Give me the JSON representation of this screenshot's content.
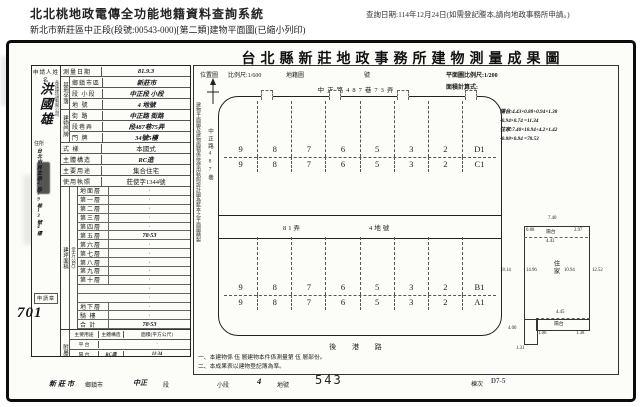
{
  "header": {
    "system_title": "北北桃地政電傳全功能地籍資料查詢系統",
    "query_date": "查詢日期:114年12月24日(如需登記謄本,請向地政事務所申請。)",
    "subtitle": "新北市新莊區中正段(段號:00543-000)[第二類]建物平面圖(已縮小列印)"
  },
  "doc": {
    "title": "台北縣新莊地政事務所建物測量成果圖"
  },
  "applicant": {
    "label": "申請人姓名",
    "name": "洪國雄",
    "company": "永達建設有限公司",
    "addr_label": "住所",
    "address": "台北市民生路2段79巷13號4樓",
    "stamp": "申請章",
    "receipt_no": "701"
  },
  "form": {
    "site_group": "基地坐落",
    "door_group": "建物門牌",
    "rows": [
      {
        "label": "測量日期",
        "value": "81.9.3"
      },
      {
        "label": "鄉鎮市區",
        "value": "新莊市"
      },
      {
        "label": "段 小段",
        "value": "中正段 小段"
      },
      {
        "label": "地 號",
        "value": "4 地號"
      },
      {
        "label": "街 路",
        "value": "中正路 街路"
      },
      {
        "label": "段巷弄",
        "value": "段487巷75弄"
      },
      {
        "label": "門 牌",
        "value": "34號5樓"
      },
      {
        "label": "式 樣",
        "value": "本國式"
      },
      {
        "label": "主體構造",
        "value": "RC造"
      },
      {
        "label": "主要用途",
        "value": "集合住宅"
      },
      {
        "label": "使用執照",
        "value": "莊使字1344號"
      }
    ]
  },
  "floors": {
    "side": "建坪面積",
    "unit": "(平方公尺)",
    "rows": [
      {
        "label": "地面層",
        "value": "·"
      },
      {
        "label": "第一層",
        "value": "·"
      },
      {
        "label": "第二層",
        "value": "·"
      },
      {
        "label": "第三層",
        "value": "·"
      },
      {
        "label": "第四層",
        "value": "·"
      },
      {
        "label": "第五層",
        "value": "78·53"
      },
      {
        "label": "第六層",
        "value": "·"
      },
      {
        "label": "第七層",
        "value": "·"
      },
      {
        "label": "第八層",
        "value": "·"
      },
      {
        "label": "第九層",
        "value": "·"
      },
      {
        "label": "第十層",
        "value": "·"
      },
      {
        "label": "",
        "value": "·"
      },
      {
        "label": "",
        "value": "·"
      },
      {
        "label": "地下層",
        "value": "·"
      },
      {
        "label": "騎 樓",
        "value": "·"
      },
      {
        "label": "合 計",
        "value": "78·53"
      }
    ]
  },
  "annex": {
    "side": "附屬建物",
    "headers": [
      "主要用途",
      "主體構造",
      "面積(平方公尺)"
    ],
    "rows": [
      {
        "use": "平 台",
        "struct": "",
        "area": "·"
      },
      {
        "use": "陽 台",
        "struct": "RC造",
        "area": "11·34"
      },
      {
        "use": "",
        "struct": "",
        "area": "·"
      },
      {
        "use": "合 計",
        "struct": "",
        "area": "11·34"
      }
    ]
  },
  "map": {
    "loc_label": "位置圖",
    "loc_scale": "比例尺:1/600",
    "cadastre_label": "地籍圖",
    "cadastre_no": "號",
    "plan_scale": "平面圖比例尺:1/200",
    "calc_label": "面積計算式:",
    "street_top": "中正路487巷73弄",
    "street_left": "中正路487巷",
    "alley": "81弄",
    "lot": "4地號",
    "street_bottom": "後 港 路",
    "side_note": "建物平面圖及建物面積係依使用執照設計圖為藍本之平面圖精製",
    "rows": [
      {
        "cells": [
          "9",
          "8",
          "7",
          "6",
          "5",
          "3",
          "2",
          "D1"
        ]
      },
      {
        "cells": [
          "9",
          "8",
          "7",
          "6",
          "5",
          "3",
          "2",
          "C1"
        ]
      },
      {
        "cells": [
          "9",
          "8",
          "7",
          "6",
          "5",
          "3",
          "2",
          "B1"
        ]
      },
      {
        "cells": [
          "9",
          "8",
          "7",
          "6",
          "5",
          "3",
          "2",
          "A1"
        ]
      }
    ],
    "calc_lines": [
      "陽台:4.43×0.88+0.94×1.38",
      "-0.94×0.74 =11.34",
      "住家:7.40×10.94+4.2×1.42",
      "-0.88×0.94 =78.53"
    ],
    "notes": [
      "一、本建物係 伍 層建物本件係測量第 伍 層部份。",
      "二、本成果表以建物登記簿為準。"
    ]
  },
  "plan": {
    "top_dim": "7.40",
    "top_left": "0.88",
    "top_label": "陽台",
    "top_mid": "4.43",
    "top_right": "2.97",
    "left_outer": "18.14",
    "left_inner": "14.96",
    "center": "住家",
    "right_inner": "10.94",
    "right_outer": "12.52",
    "bot_dim": "4.45",
    "bot_label": "陽台",
    "bot_l": "1.06",
    "bot_r": "1.38",
    "ll_a": "4.00",
    "ll_b": "1.31"
  },
  "footer": {
    "town": "新莊市",
    "town_label": "鄉鎮市",
    "section": "中正",
    "section_label": "段",
    "subsection_label": "小段",
    "lot": "4",
    "lot_label": "地號",
    "page": "543",
    "bldg_label": "棟次",
    "bldg": "D7-5"
  }
}
